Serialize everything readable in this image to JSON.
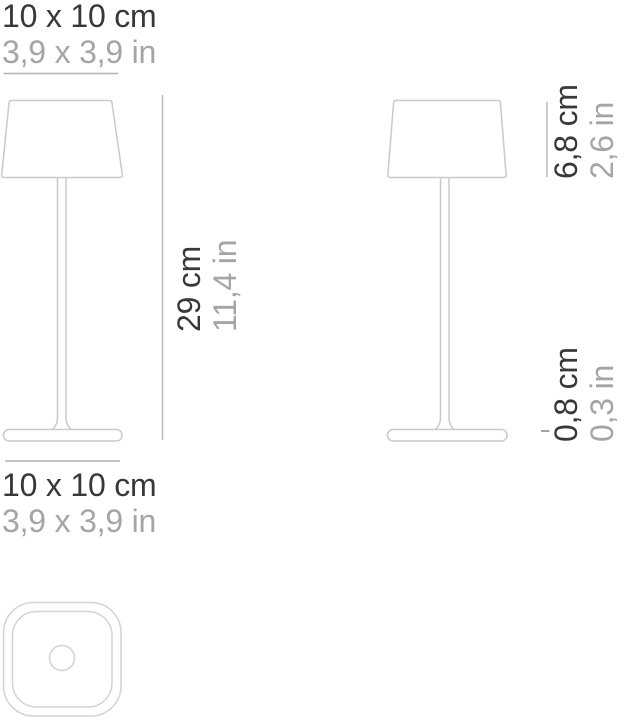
{
  "page": {
    "background": "#ffffff",
    "description_colors": {
      "primary_text": "#38383a",
      "secondary_text": "#a5a5a7",
      "dimension_line": "#b2b2b4",
      "lamp_outline": "#c9caca",
      "top_view_outline": "#d2d3d3"
    }
  },
  "dimensions": {
    "top_width": {
      "metric": "10 x 10 cm",
      "imperial": "3,9 x 3,9 in"
    },
    "total_height": {
      "metric": "29 cm",
      "imperial": "11,4 in"
    },
    "shade_height": {
      "metric": "6,8 cm",
      "imperial": "2,6 in"
    },
    "base_height": {
      "metric": "0,8 cm",
      "imperial": "0,3 in"
    },
    "base_width": {
      "metric": "10 x 10 cm",
      "imperial": "3,9 x 3,9 in"
    }
  }
}
